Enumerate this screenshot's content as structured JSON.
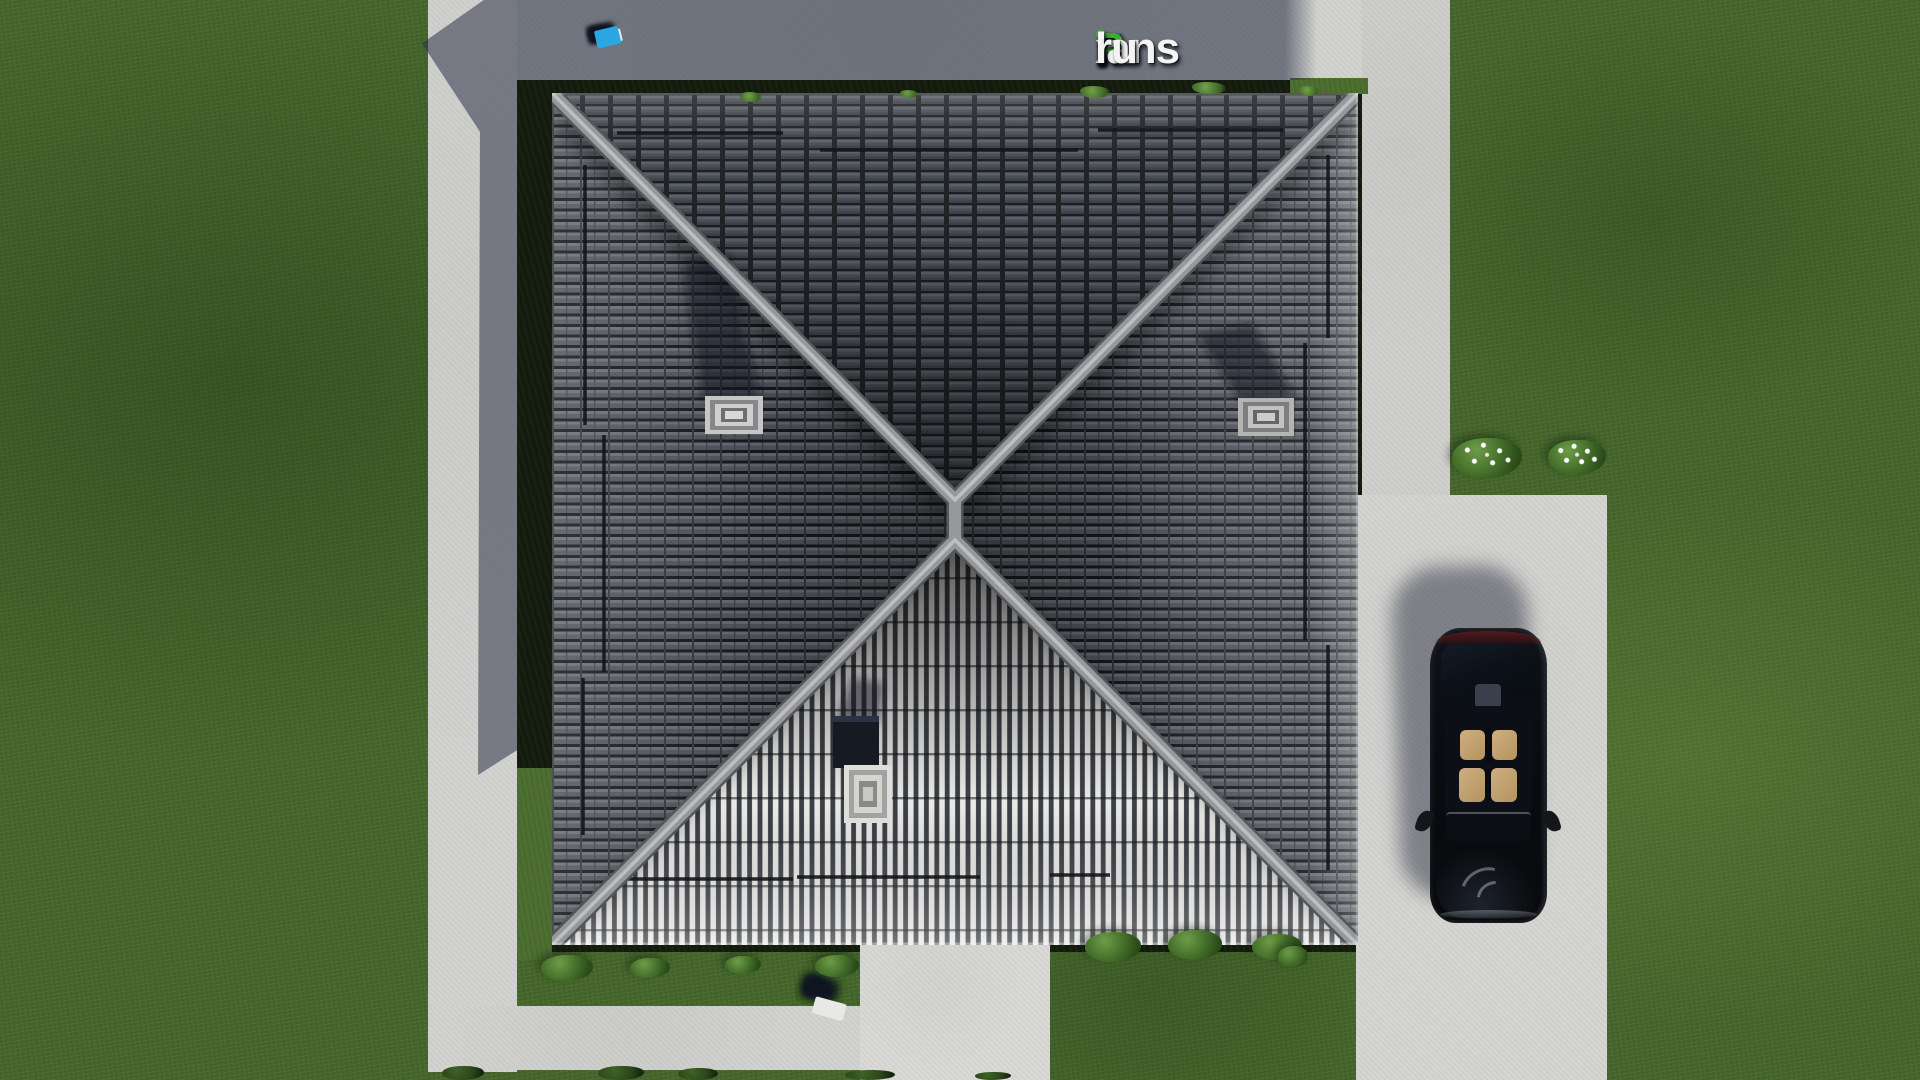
{
  "brand": {
    "full_text": "FixPlans.ru",
    "f": "F",
    "i": "i",
    "x": "x",
    "p": "P",
    "lans": "lans",
    "dot": ".",
    "ru": "ru",
    "colors": {
      "blue": "#2d64cf",
      "green": "#3cae27",
      "white": "#f4f4f2",
      "dot_blue": "#2196dd",
      "i_dot_green": "#44b626"
    }
  },
  "scene": {
    "description": "Aerial top-down 3D architectural render: house with dark hipped tile roof (bright sunlit south slope), two roof windows with cast shadows, chimney skylight, snow-guard bars, lawn, L-shaped concrete paths, front walkway with scattered white/blue/green planks, boundary fence planks at top, driveway with parked black car, flowering bushes",
    "objects": [
      "hipped-roof",
      "roof-window",
      "chimney-skylight",
      "snow-guards",
      "lawn",
      "concrete-path",
      "driveway",
      "walkway",
      "black-car",
      "fence-planks",
      "bushes",
      "flower-bushes",
      "house-shadow"
    ],
    "palette": {
      "grass": "#46682c",
      "grass_light": "#5c8140",
      "concrete": "#d2d2cf",
      "shadow_on_concrete": "#5d6373",
      "roof_tile": "#4f535a",
      "roof_tile_gap": "#1c1e21",
      "roof_ridge": "#96989b",
      "roof_sunlit_stripe": "#e9eae8",
      "perimeter_dark": "#131a0e",
      "car_body": "#0a0c10",
      "car_seats": "#c3a478",
      "car_taillight": "#5a1616",
      "fence_white": "#e8e8e4",
      "fence_blue": "#2aa7e0",
      "fence_green": "#52c22c"
    }
  }
}
